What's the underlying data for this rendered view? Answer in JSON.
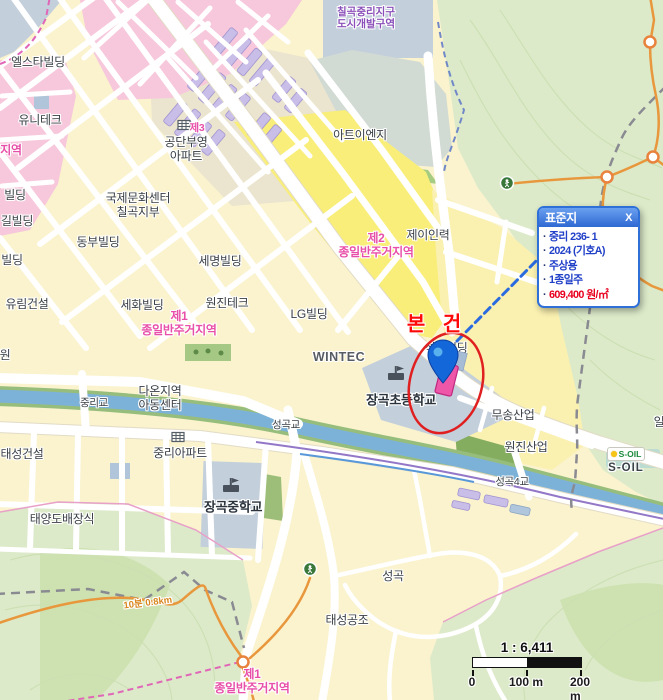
{
  "popup": {
    "title": "표준지",
    "close": "X",
    "accent_color": "#2E6FD8",
    "text_color": "#2140C8",
    "price_color": "#E8001E",
    "items": [
      {
        "text": "중리 236- 1"
      },
      {
        "text": "2024 (기호A)"
      },
      {
        "text": "주상용"
      },
      {
        "text": "1종일주"
      },
      {
        "text": "609,400 원/㎡",
        "emphasis": true
      }
    ]
  },
  "annotation": {
    "subject_label": "본 건",
    "color": "#FF0808"
  },
  "scale_bar": {
    "ratio": "1 : 6,411",
    "ticks": [
      "0",
      "100 m",
      "200 m"
    ]
  },
  "brand": {
    "soil_logo": "S-OIL",
    "soil_name": "S-OIL"
  },
  "map": {
    "zone_colors": {
      "residential_cream": "#FAF3CE",
      "bright_yellow": "#F8EE79",
      "commercial_pink": "#F7C8DB",
      "apartment_purple": "#C8BEE8",
      "institution_gray": "#C3CFDB",
      "forest_green": "#DCEAC9",
      "river_blue": "#7DB2D8",
      "trail_orange": "#E8973C"
    },
    "labels": [
      {
        "t": "칠곡중리지구\n도시개발구역",
        "x": 366,
        "y": 18,
        "c": "zpu"
      },
      {
        "t": "엘스타빌딩",
        "x": 38,
        "y": 63,
        "c": "b"
      },
      {
        "t": "유니테크",
        "x": 40,
        "y": 121,
        "c": "b"
      },
      {
        "t": "지역",
        "x": 11,
        "y": 151,
        "c": "zp"
      },
      {
        "t": "제3",
        "x": 197,
        "y": 128,
        "c": "zps"
      },
      {
        "t": "공단부영\n아파트",
        "x": 186,
        "y": 150,
        "c": "b"
      },
      {
        "t": "국제문화센터\n칠곡지부",
        "x": 138,
        "y": 206,
        "c": "b"
      },
      {
        "t": "동부빌딩",
        "x": 98,
        "y": 243,
        "c": "b"
      },
      {
        "t": "세명빌딩",
        "x": 220,
        "y": 262,
        "c": "b"
      },
      {
        "t": "빌딩",
        "x": 15,
        "y": 196,
        "c": "b"
      },
      {
        "t": "길빌딩",
        "x": 17,
        "y": 222,
        "c": "b"
      },
      {
        "t": "빌딩",
        "x": 12,
        "y": 261,
        "c": "b"
      },
      {
        "t": "유림건설",
        "x": 27,
        "y": 305,
        "c": "b"
      },
      {
        "t": "세화빌딩",
        "x": 142,
        "y": 306,
        "c": "b"
      },
      {
        "t": "원진테크",
        "x": 227,
        "y": 304,
        "c": "b"
      },
      {
        "t": "LG빌딩",
        "x": 309,
        "y": 315,
        "c": "b"
      },
      {
        "t": "WINTEC",
        "x": 339,
        "y": 357,
        "c": "lt"
      },
      {
        "t": "아트이엔지",
        "x": 360,
        "y": 136,
        "c": "b"
      },
      {
        "t": "제이인력",
        "x": 428,
        "y": 236,
        "c": "b"
      },
      {
        "t": "제2\n종일반주거지역",
        "x": 376,
        "y": 246,
        "c": "zp"
      },
      {
        "t": "제1\n종일반주거지역",
        "x": 179,
        "y": 324,
        "c": "zp"
      },
      {
        "t": "석준빌딩",
        "x": 446,
        "y": 349,
        "c": "b"
      },
      {
        "t": "장곡초등학교",
        "x": 401,
        "y": 401,
        "c": "sc"
      },
      {
        "t": "다온지역\n아동센터",
        "x": 160,
        "y": 399,
        "c": "b"
      },
      {
        "t": "중리교",
        "x": 94,
        "y": 403,
        "c": "bs"
      },
      {
        "t": "태성건설",
        "x": 22,
        "y": 455,
        "c": "b"
      },
      {
        "t": "중리아파트",
        "x": 180,
        "y": 454,
        "c": "b"
      },
      {
        "t": "태양도배장식",
        "x": 62,
        "y": 520,
        "c": "b"
      },
      {
        "t": "장곡중학교",
        "x": 233,
        "y": 508,
        "c": "sc"
      },
      {
        "t": "무송산업",
        "x": 513,
        "y": 416,
        "c": "b"
      },
      {
        "t": "원진산업",
        "x": 526,
        "y": 448,
        "c": "b"
      },
      {
        "t": "성곡교",
        "x": 286,
        "y": 425,
        "c": "bs"
      },
      {
        "t": "성곡4교",
        "x": 512,
        "y": 482,
        "c": "bs"
      },
      {
        "t": "성곡",
        "x": 393,
        "y": 577,
        "c": "b"
      },
      {
        "t": "태성공조",
        "x": 347,
        "y": 621,
        "c": "b"
      },
      {
        "t": "제1\n종일반주거지역",
        "x": 252,
        "y": 682,
        "c": "zp"
      },
      {
        "t": "원",
        "x": 5,
        "y": 356,
        "c": "b"
      },
      {
        "t": "일",
        "x": 659,
        "y": 423,
        "c": "b"
      },
      {
        "t": "10분 0.8km",
        "x": 148,
        "y": 604,
        "c": "tr",
        "r": -7
      }
    ]
  }
}
